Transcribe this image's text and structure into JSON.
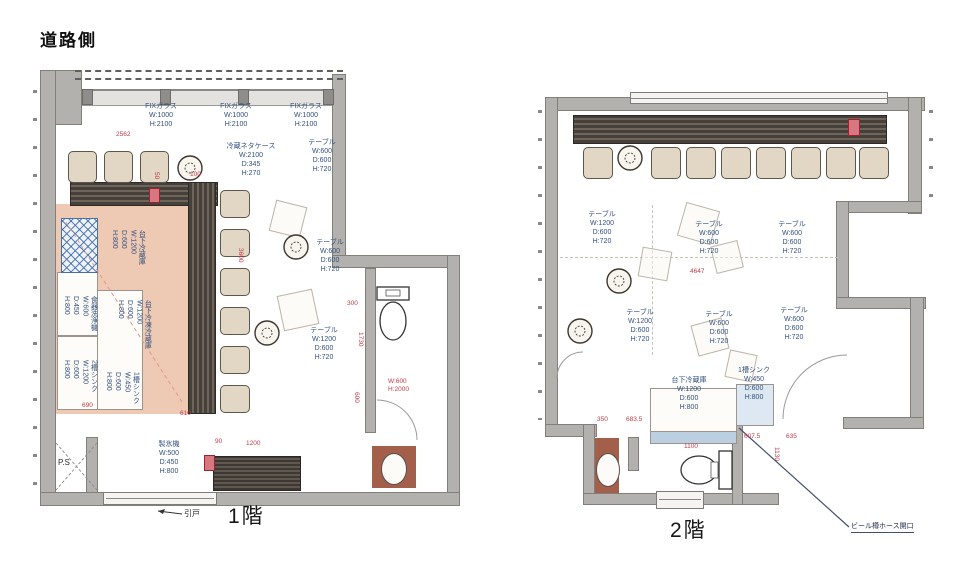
{
  "site": {
    "road_side": "道路側"
  },
  "colors": {
    "wall_gray": "#b3b1ae",
    "counter_wood": "#46403b",
    "kitchen_floor": "#eec9b4",
    "label_blue": "#33517e",
    "dimension_red": "#c03a48"
  },
  "floor1": {
    "title": "1階",
    "fix_glass": [
      "FIXガラス\nW:1000\nH:2100",
      "FIXガラス\nW:1000\nH:2100",
      "FIXガラス\nW:1000\nH:2100"
    ],
    "neta_case": "冷蔵ネタケース\nW:2100\nD:345\nH:270",
    "tables": [
      "テーブル\nW:600\nD:600\nH:720",
      "テーブル\nW:600\nD:600\nH:720",
      "テーブル\nW:1200\nD:600\nH:720"
    ],
    "ice_maker": "製氷機\nW:500\nD:450\nH:800",
    "equipment_left": [
      "食器洗浄機\nW:600\nD:450\nH:800",
      "台下冷蔵庫\nW:1200\nD:600\nH:800",
      "台下冷凍冷蔵庫\nW:1200\nD:600\nH:800",
      "2槽シンク\nW:1200\nD:600\nH:800",
      "1槽シンク\nW:450\nD:600\nH:800"
    ],
    "ps": "P.S",
    "sliding_door": "引戸",
    "dims": {
      "top": "2562",
      "aisle": "3600",
      "corner": "100",
      "fifty": "50",
      "d610": "610",
      "d90": "90",
      "d1200": "1200",
      "d690": "690",
      "d300": "300",
      "d1730": "1730",
      "d600": "600",
      "door": "W:600\nH:2000"
    }
  },
  "floor2": {
    "title": "2階",
    "tables": [
      "テーブル\nW:1200\nD:600\nH:720",
      "テーブル\nW:600\nD:600\nH:720",
      "テーブル\nW:600\nD:600\nH:720",
      "テーブル\nW:1200\nD:600\nH:720",
      "テーブル\nW:600\nD:600\nH:720",
      "テーブル\nW:600\nD:600\nH:720"
    ],
    "under_fridge": "台下冷蔵庫\nW:1200\nD:600\nH:800",
    "sink1": "1槽シンク\nW:450\nD:600\nH:800",
    "dims": {
      "mid": "4647",
      "d350": "350",
      "d683": "683.5",
      "d1100": "1100",
      "d607": "607.5",
      "d635": "635",
      "d1130": "1130"
    },
    "callout": "ビール樽ホース開口"
  }
}
